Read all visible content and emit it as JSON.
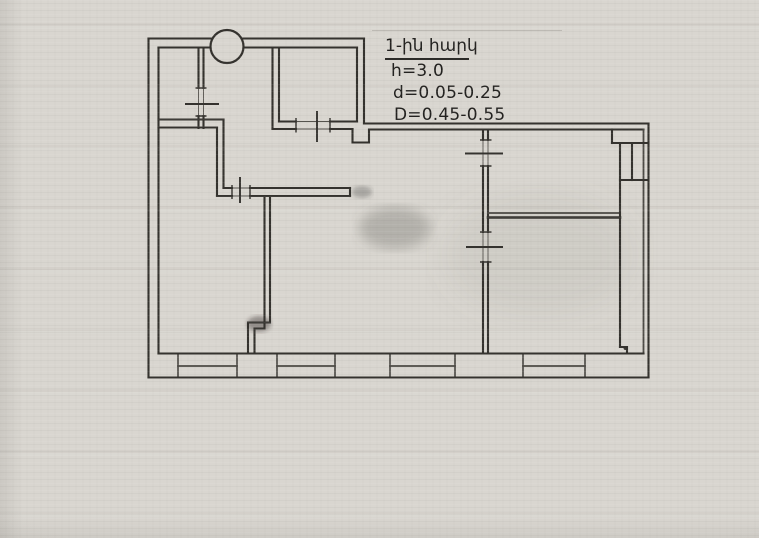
{
  "annotation": {
    "floor_label": "1-ին հարկ",
    "height_value": "h=3.0",
    "d_value": "d=0.05-0.25",
    "big_d_value": "D=0.45-0.55"
  },
  "colors": {
    "paper": "#d9d6d0",
    "ink": "#34322e",
    "text": "#22211f"
  }
}
